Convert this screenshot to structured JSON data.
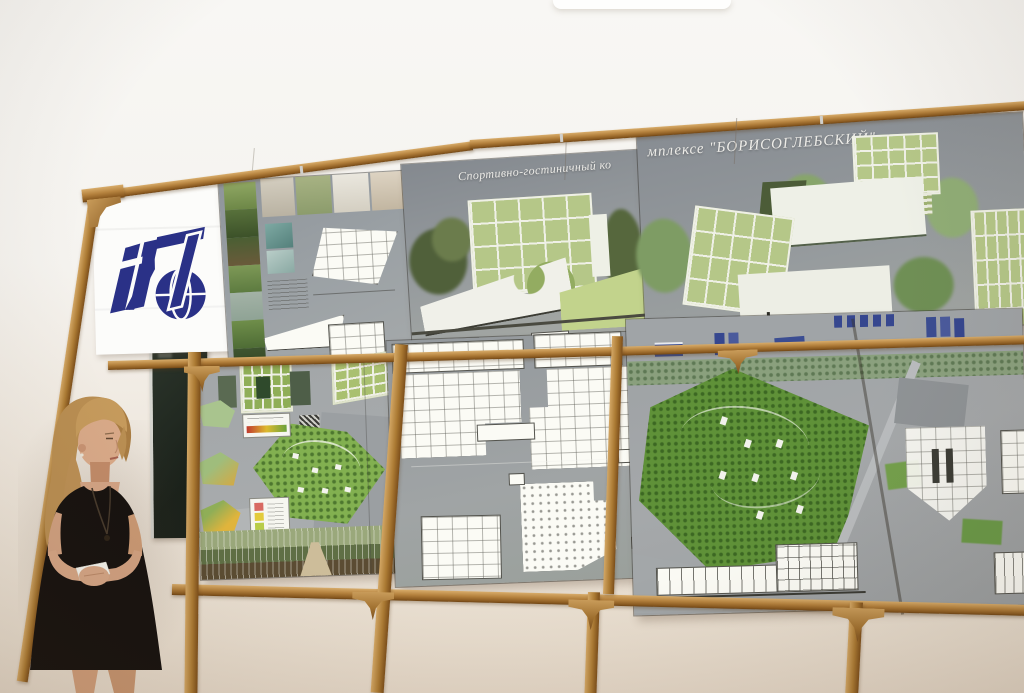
{
  "scene": {
    "description": "Photograph of an architectural project presentation: a woman in a black dress stands beside wood-framed display boards",
    "project_title_part1": "Спортивно-гостиничный ко",
    "project_title_part2": "мплексе \"БОРИСОГЛЕБСКИЙ\"",
    "project_title_full": "Спортивно-гостиничный комплексе \"БОРИСОГЛЕБСКИЙ\""
  },
  "logo": {
    "name": "design-institute-logo",
    "color": "#2a3187",
    "background": "#fcfcfa"
  },
  "panels": [
    {
      "id": "board-photos-plans",
      "content": "nature photo strip, interior renders, triangular floor plans"
    },
    {
      "id": "board-main-render",
      "content": "render of white building with green glazed grid facade"
    },
    {
      "id": "board-render-collage",
      "content": "renders of green grid volumes among trees"
    },
    {
      "id": "board-site-analysis",
      "content": "site plan, thematic maps, color legends, forest panorama"
    },
    {
      "id": "board-floor-plans",
      "content": "white floor plans on grey field"
    },
    {
      "id": "board-aerial-view",
      "content": "aerial view of forested site with sections"
    }
  ],
  "person": {
    "description": "female presenter, blonde hair, black dress, holding notes"
  },
  "palette": {
    "wall_top": "#f8f7f4",
    "wall_bottom": "#e3d6c6",
    "wood": "#b5823e",
    "board_grey": "#9aa0a4",
    "facade_green": "#b5c788",
    "forest_green": "#5f9138",
    "chalkboard": "#232b22",
    "logo_blue": "#2a3187",
    "dress_black": "#17120f",
    "hair_blonde": "#bb8f55",
    "skin": "#d5a483"
  }
}
